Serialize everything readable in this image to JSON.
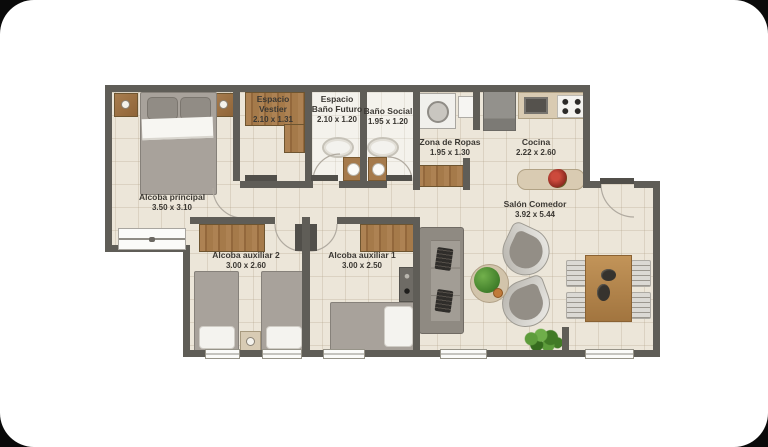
{
  "scene": {
    "type": "architectural-floor-plan",
    "background_color": "#0a0a0a",
    "card_color": "#ffffff",
    "palette": {
      "wall": "#5f5d57",
      "floor": "#ece6d9",
      "bathroom_floor": "#f4f2ec",
      "wood_closet": "#a57a4a",
      "counter": "#d9cbb2",
      "table_wood": "#b78a52",
      "furniture_gray": "#a29d95",
      "plant_green": "#417a26",
      "flower_red": "#a93226",
      "label_text": "#3b3833"
    }
  },
  "rooms": [
    {
      "id": "alcoba-principal",
      "name": "Alcoba principal",
      "dims": "3.50 x 3.10"
    },
    {
      "id": "espacio-vestier",
      "name": "Espacio Vestier",
      "dims": "2.10 x 1.31"
    },
    {
      "id": "espacio-bano-futuro",
      "name": "Espacio Baño Futuro",
      "dims": "2.10 x 1.20"
    },
    {
      "id": "bano-social",
      "name": "Baño Social",
      "dims": "1.95 x 1.20"
    },
    {
      "id": "zona-de-ropas",
      "name": "Zona de Ropas",
      "dims": "1.95 x 1.30"
    },
    {
      "id": "cocina",
      "name": "Cocina",
      "dims": "2.22 x 2.60"
    },
    {
      "id": "salon-comedor",
      "name": "Salón Comedor",
      "dims": "3.92 x 5.44"
    },
    {
      "id": "alcoba-auxiliar-2",
      "name": "Alcoba auxiliar 2",
      "dims": "3.00 x 2.60"
    },
    {
      "id": "alcoba-auxiliar-1",
      "name": "Alcoba auxiliar 1",
      "dims": "3.00 x 2.50"
    }
  ]
}
